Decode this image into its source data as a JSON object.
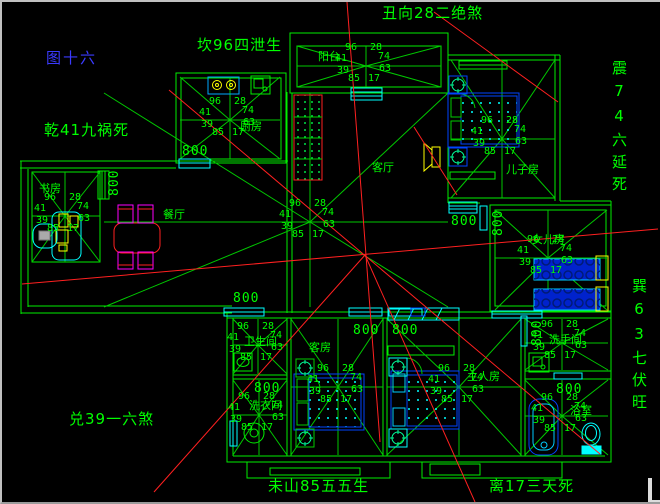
{
  "figure_label": "图十六",
  "compass_labels": {
    "top_center": "丑向28二绝煞",
    "top_left": "坎96四泄生",
    "mid_left": "乾41九祸死",
    "right_upper": "震74六延死",
    "right_lower": "巽63七伏旺",
    "bottom_left": "兑39一六煞",
    "bottom_center": "未山85五五生",
    "bottom_right": "离17三天死"
  },
  "star": {
    "tl": "96",
    "tr": "28",
    "ml": "41",
    "mr": "74",
    "ll": "39",
    "lr": "63",
    "bl": "85",
    "br": "17"
  },
  "rooms": {
    "kitchen": {
      "label": "厨房"
    },
    "study": {
      "label": "书房"
    },
    "balcony": {
      "label": "阳台"
    },
    "living": {
      "label": "客厅"
    },
    "dining": {
      "label": "餐厅"
    },
    "son": {
      "label": "儿子房"
    },
    "daughter": {
      "label": "女儿房"
    },
    "bath1": {
      "label": "卫生间"
    },
    "laundry": {
      "label": "洗衣间"
    },
    "guest": {
      "label": "客房"
    },
    "master": {
      "label": "主人房"
    },
    "washroom": {
      "label": "洗手间"
    },
    "bath2": {
      "label": "浴室"
    }
  },
  "dimension": {
    "v800": "800"
  },
  "colors": {
    "wall_green": "#00ff00",
    "ray_green": "#00c800",
    "red_line": "#ff2020",
    "figure_blue": "#3a3aff",
    "furniture_blue": "#0044ff",
    "cyan": "#00ffff",
    "yellow": "#ffff00",
    "magenta": "#ff00ff"
  }
}
